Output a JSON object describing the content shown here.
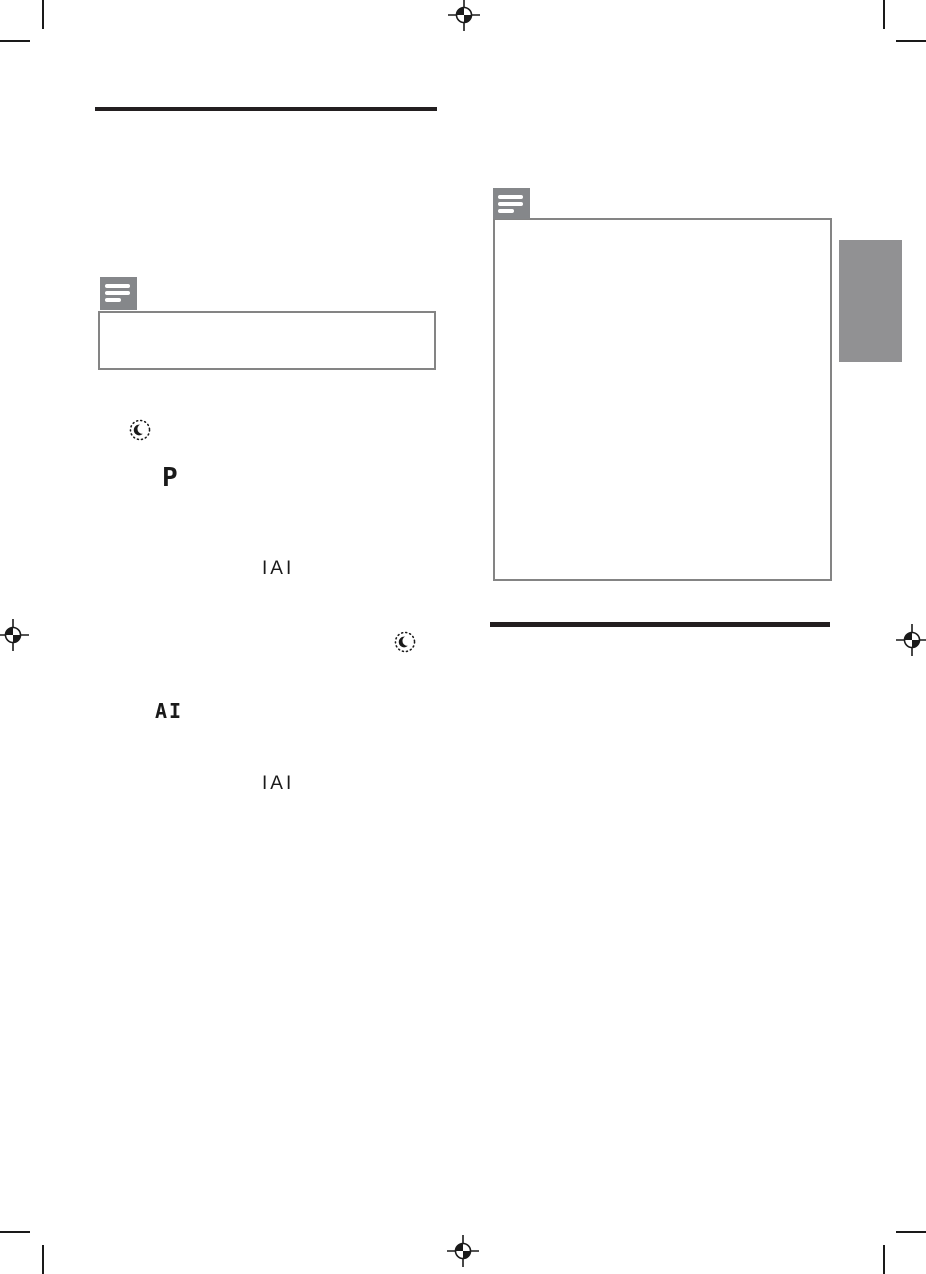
{
  "document": {
    "type": "printed-manual-page",
    "page_background": "#ffffff",
    "visible_body_text": ""
  },
  "colors": {
    "print_black": "#231f20",
    "glyph_black": "#1a1a1a",
    "note_icon_gray": "#85878a",
    "callout_border_gray": "#848484",
    "chapter_tab_gray": "#919193"
  },
  "left_column": {
    "heading_rule": "black-section-divider",
    "note_icon": "note-icon",
    "note_box_text": "",
    "sleep_timer_icon_1": "crescent-moon-in-dotted-circle",
    "display_glyph_p": "P",
    "display_text_iai_1": "IAI",
    "sleep_timer_icon_2": "crescent-moon-in-dotted-circle",
    "display_glyph_ai": "AI",
    "display_text_iai_2": "IAI"
  },
  "right_column": {
    "note_icon": "note-icon",
    "note_box_text": "",
    "heading_rule": "black-section-divider"
  },
  "print_marks": {
    "registration_marks": [
      "top-center",
      "left-middle",
      "right-middle",
      "bottom-center"
    ],
    "corner_crop_ticks": [
      "top-left",
      "top-right",
      "bottom-left",
      "bottom-right"
    ]
  },
  "side_tab": {
    "label": ""
  }
}
